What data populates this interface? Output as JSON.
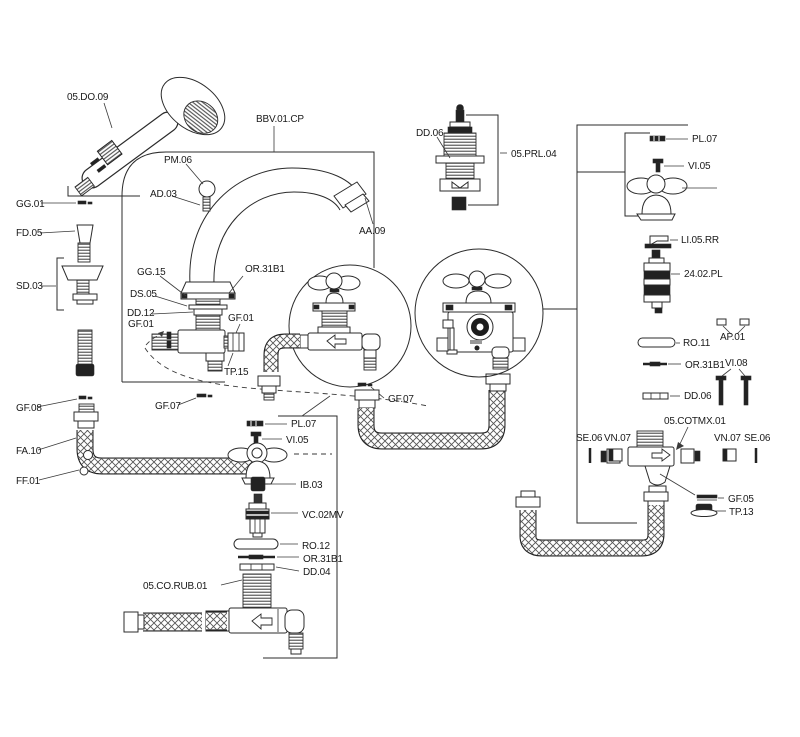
{
  "page": {
    "kind": "exploded-parts-diagram",
    "subject": "deck-mount bath faucet with handshower — spare parts diagram",
    "background_color": "#ffffff",
    "line_color": "#2b2b2b"
  },
  "part_labels": {
    "do_09": "05.DO.09",
    "bbv_01_cp": "BBV.01.CP",
    "pm_06": "PM.06",
    "ad_03": "AD.03",
    "gg_01": "GG.01",
    "aa_09": "AA.09",
    "fd_05": "FD.05",
    "gg_15": "GG.15",
    "or_31b1": "OR.31B1",
    "ds_05": "DS.05",
    "sd_03": "SD.03",
    "dd_12": "DD.12",
    "gf_01": "GF.01",
    "tp_15": "TP.15",
    "gf_08": "GF.08",
    "gf_07": "GF.07",
    "fa_10": "FA.10",
    "ff_01": "FF.01",
    "dd_06": "DD.06",
    "prl_04": "05.PRL.04",
    "pl_07": "PL.07",
    "vi_05": "VI.05",
    "li_05_rr": "LI.05.RR",
    "pl_24_02": "24.02.PL",
    "ap_01": "AP.01",
    "ro_11": "RO.11",
    "vi_08": "VI.08",
    "se_06": "SE.06",
    "vn_07": "VN.07",
    "cotmx_01": "05.COTMX.01",
    "gf_05": "GF.05",
    "tp_13": "TP.13",
    "ib_03": "IB.03",
    "vc_02mv": "VC.02MV",
    "ro_12": "RO.12",
    "dd_04": "DD.04",
    "co_rub_01": "05.CO.RUB.01"
  }
}
